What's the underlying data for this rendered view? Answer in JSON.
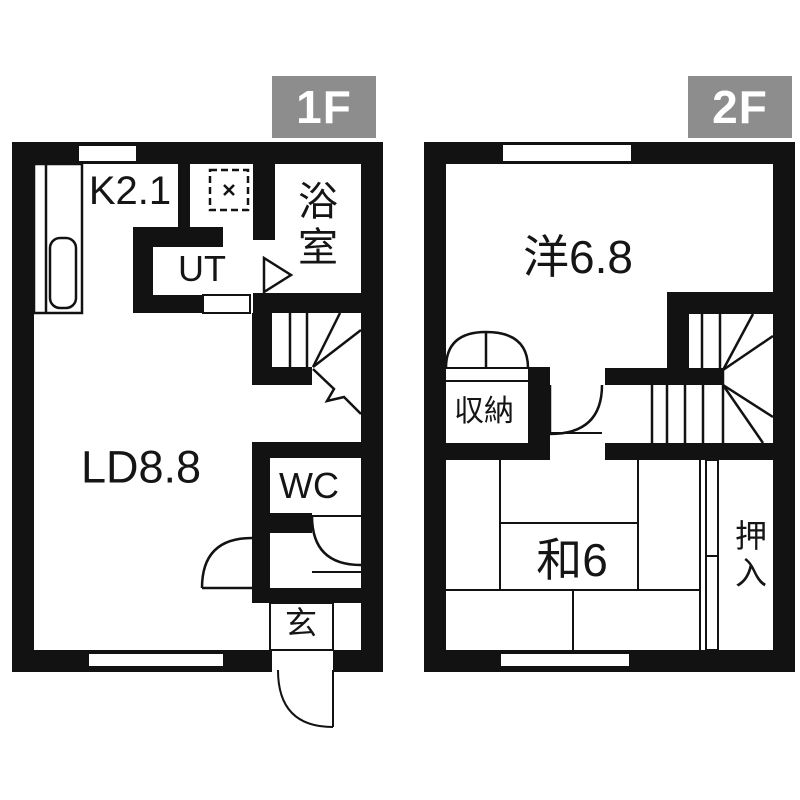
{
  "document": {
    "type": "floor-plan",
    "style": "japanese-real-estate"
  },
  "colors": {
    "wall": "#121212",
    "background": "#ffffff",
    "floor_tag_bg": "#8d8d8d",
    "floor_tag_text": "#ffffff"
  },
  "floors": [
    {
      "label": "1F",
      "rooms": {
        "kitchen": "K2.1",
        "utility": "UT",
        "bath": "浴室",
        "living_dining": "LD8.8",
        "toilet": "WC",
        "entrance": "玄"
      }
    },
    {
      "label": "2F",
      "rooms": {
        "western_room": "洋6.8",
        "storage": "収納",
        "japanese_room": "和6",
        "closet": "押入"
      }
    }
  ]
}
